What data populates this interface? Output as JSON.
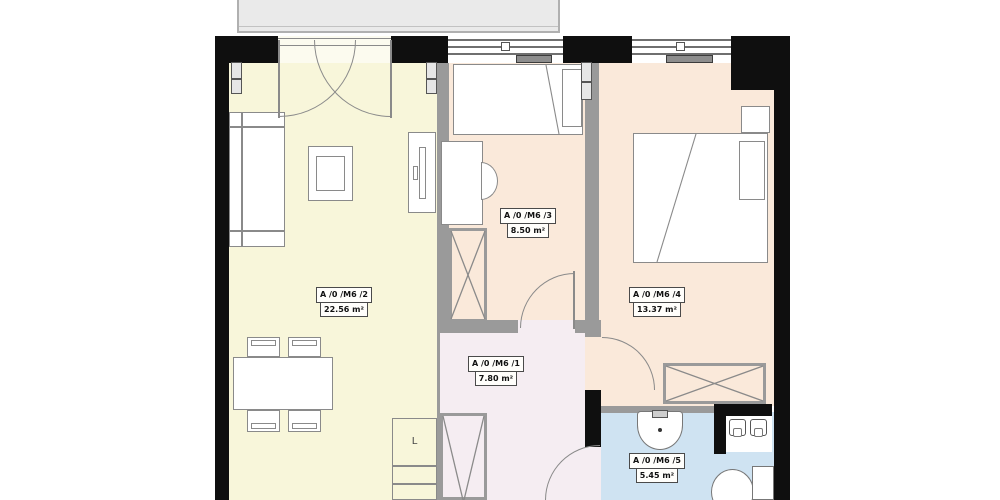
{
  "title": "apartment floor plan A /0 /M6",
  "rooms": [
    {
      "id": "hall",
      "code": "A /0 /M6 /1",
      "area": "7.80 m²"
    },
    {
      "id": "living-room",
      "code": "A /0 /M6 /2",
      "area": "22.56 m²"
    },
    {
      "id": "bedroom-small",
      "code": "A /0 /M6 /3",
      "area": "8.50 m²"
    },
    {
      "id": "bedroom-large",
      "code": "A /0 /M6 /4",
      "area": "13.37 m²"
    },
    {
      "id": "bathroom",
      "code": "A /0 /M6 /5",
      "area": "5.45 m²"
    }
  ],
  "kitchen_unit_label": "L",
  "colors": {
    "living_room_floor": "#f8f6da",
    "bedroom_floor": "#fae9da",
    "hall_floor": "#f5edf2",
    "bathroom_floor": "#cfe3f2",
    "wall": "#0f0f0f",
    "partition": "#9a9a9a",
    "furniture_line": "#8a8a8a",
    "balcony": "#eaeaea"
  }
}
